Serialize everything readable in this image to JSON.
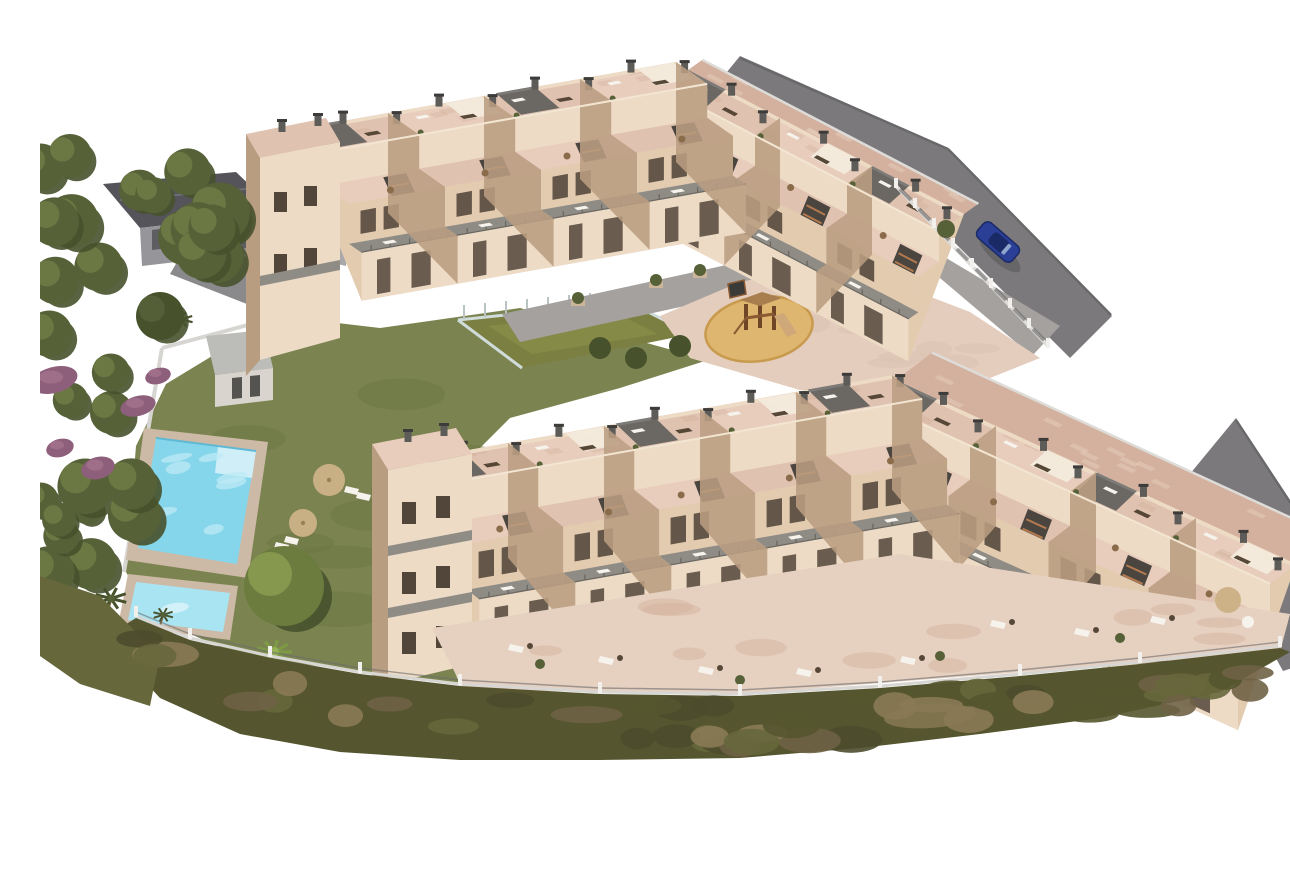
{
  "scene": {
    "kind": "aerial-3d-architectural-render",
    "palette": {
      "background": "#ffffff",
      "road": "#7b797b",
      "road_edge": "#69686a",
      "neighbor_roof": "#54545a",
      "neighbor_wall": "#96969a",
      "driveway": "#8a8a8c",
      "wall_light": "#eddbc6",
      "wall_mid": "#e3cbb0",
      "wall_shade": "#b99d81",
      "terrace_pink": "#e8cdbd",
      "terrace_pink2": "#e0c2b0",
      "terrace_pink_dark": "#d3b19e",
      "roof_dark": "#6b6864",
      "roof_edge": "#7d7b78",
      "stair_dark": "#4a463f",
      "stair_step": "#b5794e",
      "balcony_floor": "#8f8c86",
      "railing": "#6b6862",
      "window_dark": "#52463a",
      "lawn": "#7b8450",
      "lawn_dark": "#6c7544",
      "tree_green": "#566138",
      "tree_dark": "#47512c",
      "tree_light": "#6f7b45",
      "heather": "#8d5f7a",
      "heather_light": "#a4738f",
      "shrub_dark": "#55552f",
      "shrub_green": "#67673c",
      "shrub_brown": "#6f6246",
      "shrub_tan": "#8a7a55",
      "pool_deck": "#ccb9a6",
      "pool_water": "#85d6ea",
      "pool_water_light": "#bdeaf5",
      "pool_kids": "#a9e4f2",
      "sand": "#dfb66f",
      "sand_rim": "#c89a4d",
      "wood": "#8a5a33",
      "wood_dark": "#6e4526",
      "slide": "#cfa87a",
      "fence_light": "#dedcd8",
      "fence_post": "#f2f0ec",
      "fence_rail": "#5c5c5e",
      "court_green": "#7b7f41",
      "glass": "#cfdcda",
      "paving_gray": "#a4a19f",
      "paving_pink": "#dcc3b2",
      "plaza_pink": "#e4cdbd",
      "car_blue": "#2c3f96",
      "car_dark": "#1a2a66",
      "white_furn": "#f6f3ed",
      "dark_furn": "#564737",
      "parasol": "#cdb287"
    },
    "objects": [
      {
        "label": "upper apartment row with roof terraces"
      },
      {
        "label": "lower apartment row with roof terraces"
      },
      {
        "label": "communal swimming pool"
      },
      {
        "label": "children's pool"
      },
      {
        "label": "pool-side lawn garden"
      },
      {
        "label": "sun parasols and loungers"
      },
      {
        "label": "pool house outbuilding"
      },
      {
        "label": "fenced sports court"
      },
      {
        "label": "central playground with wooden play tower"
      },
      {
        "label": "courtyard paving and planters"
      },
      {
        "label": "asphalt road"
      },
      {
        "label": "parked blue car"
      },
      {
        "label": "neighbouring building with gray roof"
      },
      {
        "label": "evergreen trees and purple heather"
      },
      {
        "label": "palm trees"
      },
      {
        "label": "perimeter fence with posts"
      },
      {
        "label": "scrub slope below the complex"
      }
    ]
  }
}
